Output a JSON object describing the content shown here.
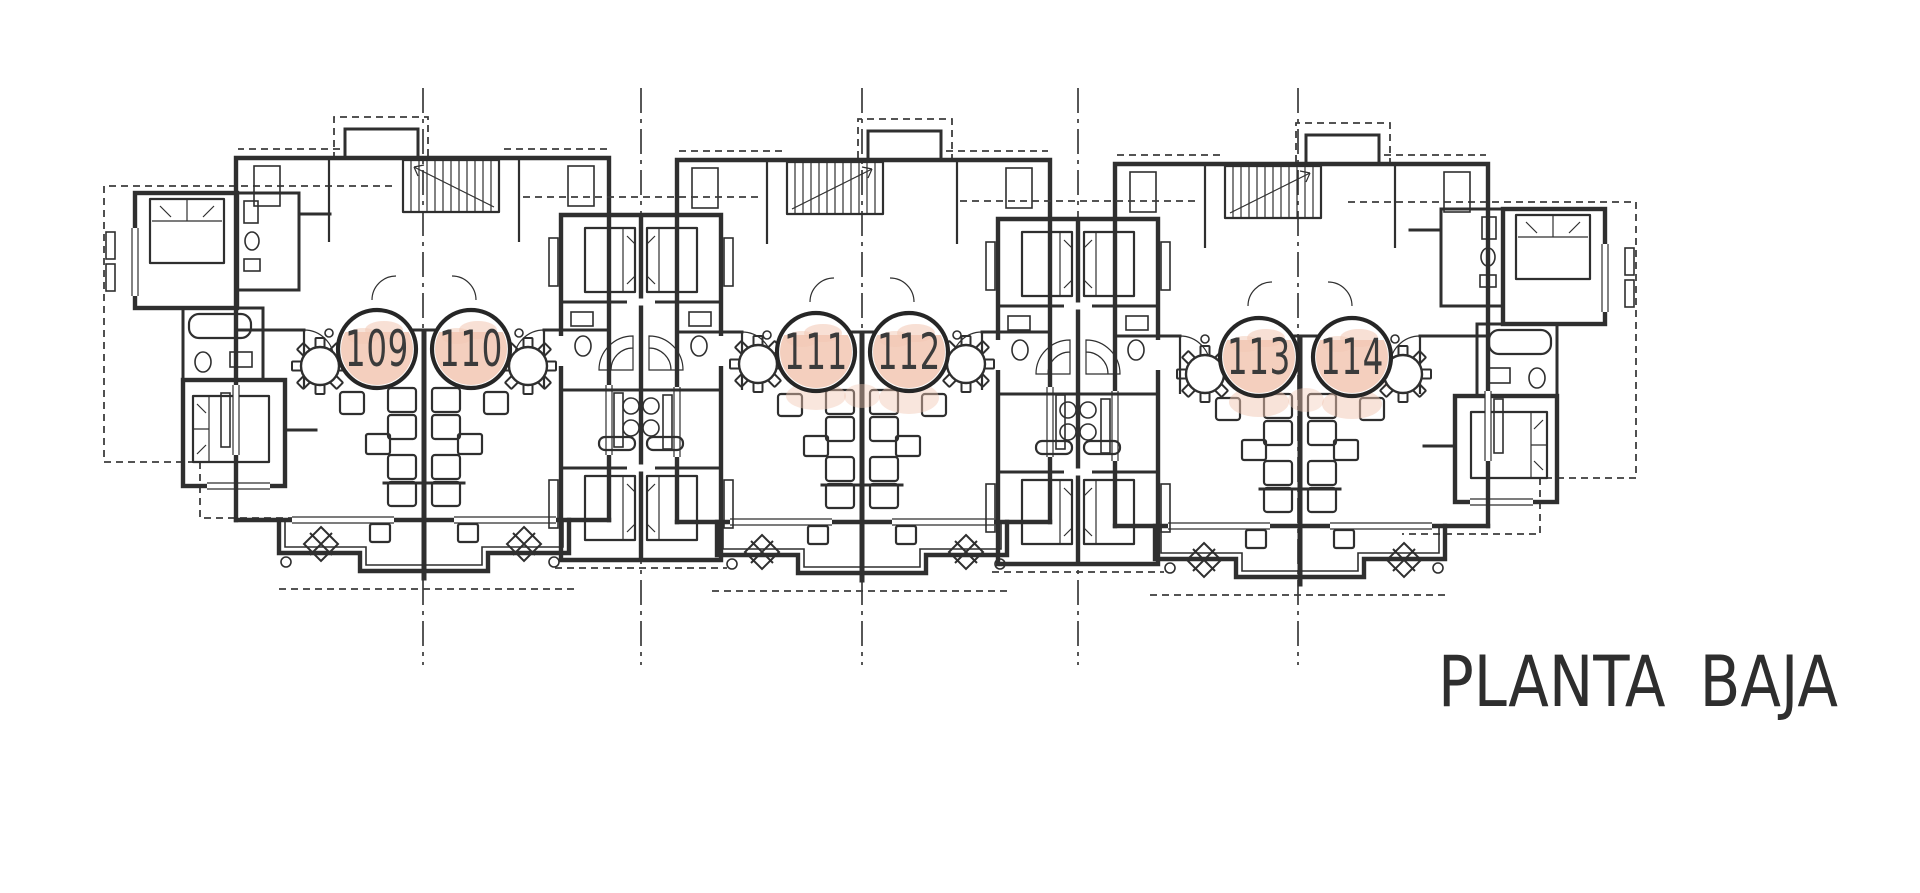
{
  "title": {
    "label": "PLANTA BAJA"
  },
  "colors": {
    "ink": "#2f2f2f",
    "highlight": "#f2c7b3",
    "paper": "#ffffff"
  },
  "units": [
    {
      "number": "109",
      "cx": 377,
      "cy": 349
    },
    {
      "number": "110",
      "cx": 471,
      "cy": 349
    },
    {
      "number": "111",
      "cx": 816,
      "cy": 352
    },
    {
      "number": "112",
      "cx": 909,
      "cy": 352
    },
    {
      "number": "113",
      "cx": 1259,
      "cy": 357
    },
    {
      "number": "114",
      "cx": 1352,
      "cy": 357
    }
  ],
  "grid_lines": {
    "x_positions": [
      423,
      641,
      862,
      1078,
      1298
    ],
    "y_start": 88,
    "y_end": 665
  },
  "furniture": {
    "round_tables": [
      [
        320,
        366
      ],
      [
        528,
        366
      ],
      [
        758,
        364
      ],
      [
        966,
        364
      ],
      [
        1205,
        374
      ],
      [
        1403,
        374
      ]
    ],
    "terrace_tables": [
      [
        321,
        544
      ],
      [
        524,
        544
      ],
      [
        762,
        552
      ],
      [
        966,
        552
      ],
      [
        1204,
        560
      ],
      [
        1404,
        560
      ]
    ]
  },
  "extra_highlights": [
    [
      816,
      396,
      30,
      14,
      0.45
    ],
    [
      909,
      398,
      30,
      16,
      0.45
    ],
    [
      862,
      396,
      18,
      12,
      0.4
    ],
    [
      1259,
      402,
      30,
      15,
      0.5
    ],
    [
      1352,
      404,
      30,
      15,
      0.5
    ],
    [
      1306,
      400,
      18,
      12,
      0.4
    ],
    [
      1398,
      380,
      18,
      10,
      0.35
    ]
  ]
}
